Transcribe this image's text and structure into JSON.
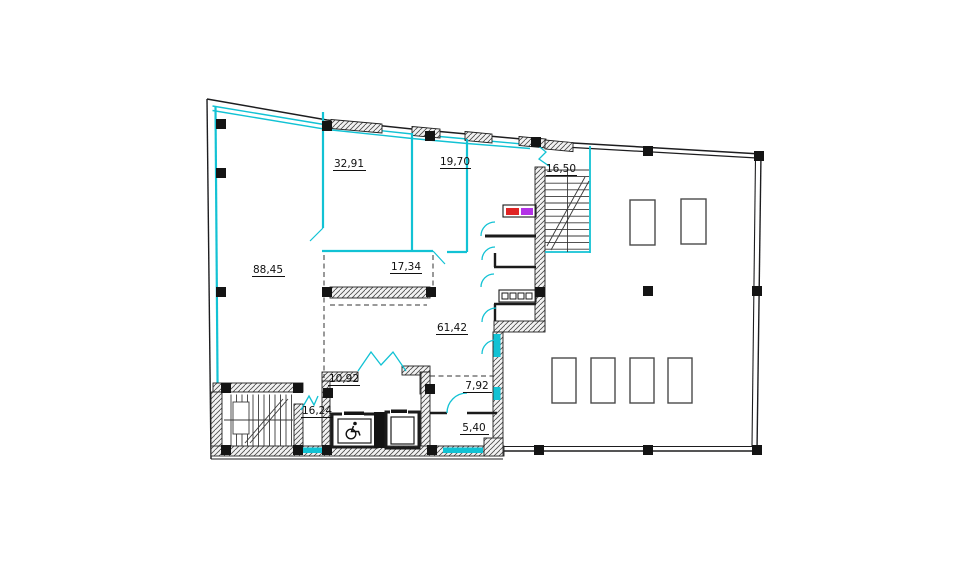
{
  "title": "ПЛАН 2 ЭТАЖА",
  "plan": {
    "rooms": [
      {
        "id": "room-32-91",
        "area": "32,91"
      },
      {
        "id": "room-19-70",
        "area": "19,70"
      },
      {
        "id": "stair-upper",
        "area": "16,50"
      },
      {
        "id": "room-88-45",
        "area": "88,45"
      },
      {
        "id": "zone-17-34",
        "area": "17,34"
      },
      {
        "id": "hall-61-42",
        "area": "61,42"
      },
      {
        "id": "lift-lobby-10-92",
        "area": "10,92"
      },
      {
        "id": "room-7-92",
        "area": "7,92"
      },
      {
        "id": "stair-lower-16-24",
        "area": "16,24"
      },
      {
        "id": "room-5-40",
        "area": "5,40"
      }
    ],
    "colors": {
      "partition_walls": "#12c2d4",
      "structure": "#1d1d1f",
      "equipment_red": "#e02424",
      "equipment_violet": "#b332e6"
    },
    "icons": {
      "wheelchair": "wheelchair-icon"
    }
  }
}
